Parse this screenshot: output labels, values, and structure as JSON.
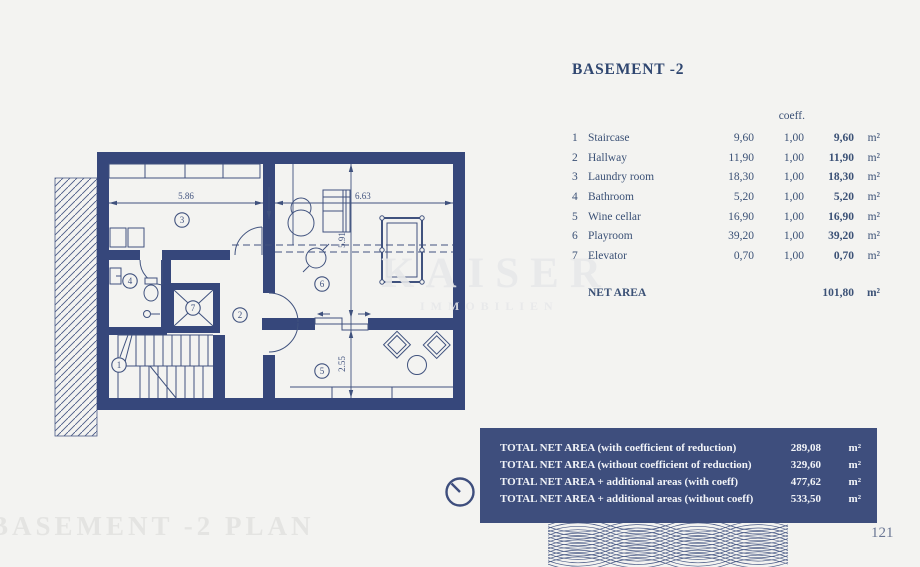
{
  "colors": {
    "wall_navy": "#36477B",
    "panel_navy": "#3E4E7D",
    "background": "#F3F3F1",
    "table_text": "#3B5176",
    "faint_title": "#E4E4E2"
  },
  "header": {
    "title": "BASEMENT -2"
  },
  "area_table": {
    "coeff_header": "coeff.",
    "rows": [
      {
        "num": "1",
        "name": "Staircase",
        "area": "9,60",
        "coeff": "1,00",
        "net": "9,60",
        "unit": "m²"
      },
      {
        "num": "2",
        "name": "Hallway",
        "area": "11,90",
        "coeff": "1,00",
        "net": "11,90",
        "unit": "m²"
      },
      {
        "num": "3",
        "name": "Laundry room",
        "area": "18,30",
        "coeff": "1,00",
        "net": "18,30",
        "unit": "m²"
      },
      {
        "num": "4",
        "name": "Bathroom",
        "area": "5,20",
        "coeff": "1,00",
        "net": "5,20",
        "unit": "m²"
      },
      {
        "num": "5",
        "name": "Wine cellar",
        "area": "16,90",
        "coeff": "1,00",
        "net": "16,90",
        "unit": "m²"
      },
      {
        "num": "6",
        "name": "Playroom",
        "area": "39,20",
        "coeff": "1,00",
        "net": "39,20",
        "unit": "m²"
      },
      {
        "num": "7",
        "name": "Elevator",
        "area": "0,70",
        "coeff": "1,00",
        "net": "0,70",
        "unit": "m²"
      }
    ],
    "net": {
      "label": "NET AREA",
      "value": "101,80",
      "unit": "m²"
    }
  },
  "totals": {
    "rows": [
      {
        "label": "TOTAL NET AREA (with coefficient of reduction)",
        "value": "289,08",
        "unit": "m²"
      },
      {
        "label": "TOTAL NET AREA (without coefficient of reduction)",
        "value": "329,60",
        "unit": "m²"
      },
      {
        "label": "TOTAL NET AREA + additional areas (with coeff)",
        "value": "477,62",
        "unit": "m²"
      },
      {
        "label": "TOTAL NET AREA + additional areas (without coeff)",
        "value": "533,50",
        "unit": "m²"
      }
    ]
  },
  "floor_plan": {
    "labels": {
      "staircase": "1",
      "hallway": "2",
      "laundry": "3",
      "bathroom": "4",
      "wine_cellar": "5",
      "playroom": "6",
      "elevator": "7"
    },
    "dimensions": {
      "laundry_width": "5.86",
      "playroom_width": "6.63",
      "playroom_depth": "5.91",
      "wine_depth": "2.55"
    }
  },
  "watermark": {
    "brand": "KAISER",
    "subtitle": "IMMOBILIEN"
  },
  "footer": {
    "plan_title": "BASEMENT -2 PLAN",
    "page_number": "121"
  }
}
